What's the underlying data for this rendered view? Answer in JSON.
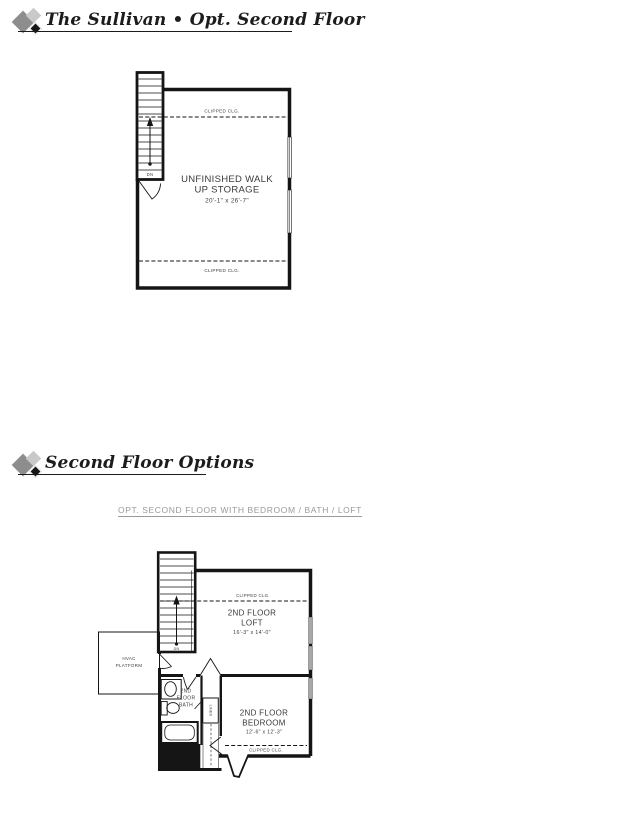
{
  "page": {
    "section1": {
      "title": "The Sullivan • Opt. Second Floor"
    },
    "section2": {
      "title": "Second Floor Options",
      "subtitle": "OPT. SECOND FLOOR WITH BEDROOM / BATH / LOFT"
    }
  },
  "plan1": {
    "stair_label": "DN",
    "clipped_clg_top": "CLIPPED CLG.",
    "clipped_clg_bottom": "CLIPPED CLG.",
    "room": {
      "name_line1": "UNFINISHED WALK",
      "name_line2": "UP STORAGE",
      "dimensions": "20'-1\" x 26'-7\""
    }
  },
  "plan2": {
    "stair_label": "DN",
    "clipped_clg_top": "CLIPPED CLG.",
    "clipped_clg_bottom": "CLIPPED CLG.",
    "loft": {
      "name_line1": "2ND FLOOR",
      "name_line2": "LOFT",
      "dimensions": "16'-3\" x 14'-0\""
    },
    "hvac": {
      "line1": "HVAC",
      "line2": "PLATFORM"
    },
    "bath": {
      "line1": "2ND",
      "line2": "FLOOR",
      "line3": "BATH"
    },
    "linen": "LINEN",
    "bedroom": {
      "name_line1": "2ND FLOOR",
      "name_line2": "BEDROOM",
      "dimensions": "12'-6\" x 12'-3\""
    }
  },
  "colors": {
    "wall": "#151515",
    "window_gray": "#a8a8a8",
    "caption_gray": "#9a9a9a",
    "diamond_gray": "#8d8d8d",
    "diamond_light": "#c9c9c9",
    "diamond_dark": "#161616"
  }
}
